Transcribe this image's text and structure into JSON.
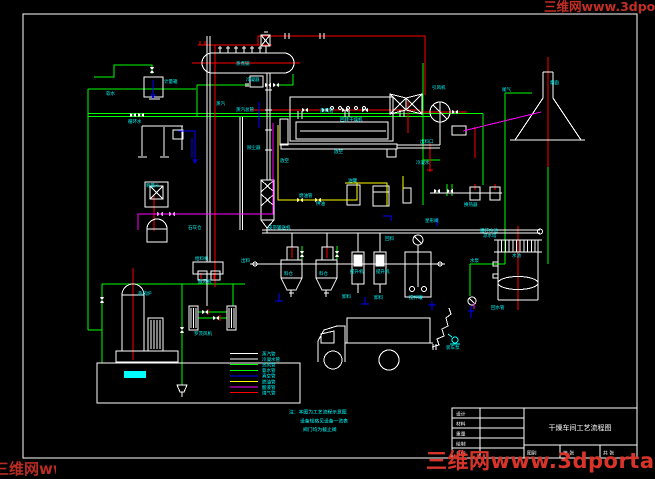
{
  "colors": {
    "background": "#000000",
    "frame": "#ffffff",
    "pipe_green": "#00ff00",
    "pipe_red": "#ff0000",
    "pipe_blue": "#0000ff",
    "pipe_yellow": "#ffff00",
    "pipe_magenta": "#ff00ff",
    "label_cyan": "#00ffff",
    "watermark_red": "#d8342a"
  },
  "watermark": {
    "text": "三维网www.3dportal.cn"
  },
  "legend": {
    "items": [
      {
        "color": "#ffffff",
        "label": "蒸汽管"
      },
      {
        "color": "#ffffff",
        "label": "冷凝水管"
      },
      {
        "color": "#00ff00",
        "label": "热风管"
      },
      {
        "color": "#00ff00",
        "label": "氨水管"
      },
      {
        "color": "#0000ff",
        "label": "真空管"
      },
      {
        "color": "#ffff00",
        "label": "燃油管"
      },
      {
        "color": "#ff00ff",
        "label": "酸液管"
      },
      {
        "color": "#ff0000",
        "label": "煤气管"
      }
    ]
  },
  "notes": {
    "lines": [
      "注：本图为工艺流程示意图",
      "设备规格见设备一览表",
      "阀门均为截止阀"
    ]
  },
  "title_block": {
    "rows": [
      {
        "label": "设计"
      },
      {
        "label": "材料"
      },
      {
        "label": "重量"
      },
      {
        "label": "绘制"
      },
      {
        "label": "日期"
      }
    ],
    "title": "干燥车间工艺流程图",
    "bottom_cells": [
      "图别",
      "第 张",
      "共 张"
    ]
  },
  "labels": [
    {
      "x": 164,
      "y": 83,
      "t": "计量箱"
    },
    {
      "x": 106,
      "y": 95,
      "t": "软水"
    },
    {
      "x": 236,
      "y": 65,
      "t": "蒸煮锅"
    },
    {
      "x": 246,
      "y": 81,
      "t": "冷凝器"
    },
    {
      "x": 128,
      "y": 123,
      "t": "循环水"
    },
    {
      "x": 236,
      "y": 111,
      "t": "蒸汽总管"
    },
    {
      "x": 320,
      "y": 112,
      "t": "热风管"
    },
    {
      "x": 340,
      "y": 121,
      "t": "回转干燥机"
    },
    {
      "x": 420,
      "y": 143,
      "t": "出料口"
    },
    {
      "x": 432,
      "y": 89,
      "t": "引风机"
    },
    {
      "x": 550,
      "y": 84,
      "t": "烟囱"
    },
    {
      "x": 247,
      "y": 149,
      "t": "除尘器"
    },
    {
      "x": 280,
      "y": 162,
      "t": "放空"
    },
    {
      "x": 334,
      "y": 153,
      "t": "放空"
    },
    {
      "x": 299,
      "y": 197,
      "t": "燃油管"
    },
    {
      "x": 316,
      "y": 205,
      "t": "供油"
    },
    {
      "x": 348,
      "y": 182,
      "t": "油罐"
    },
    {
      "x": 416,
      "y": 164,
      "t": "冷凝水"
    },
    {
      "x": 268,
      "y": 229,
      "t": "皮带输送机"
    },
    {
      "x": 241,
      "y": 262,
      "t": "出料"
    },
    {
      "x": 284,
      "y": 275,
      "t": "料仓"
    },
    {
      "x": 319,
      "y": 275,
      "t": "料仓"
    },
    {
      "x": 350,
      "y": 273,
      "t": "提升机"
    },
    {
      "x": 376,
      "y": 273,
      "t": "提升机"
    },
    {
      "x": 342,
      "y": 298,
      "t": "卸料"
    },
    {
      "x": 374,
      "y": 299,
      "t": "卸料"
    },
    {
      "x": 409,
      "y": 299,
      "t": "搅拌罐"
    },
    {
      "x": 480,
      "y": 232,
      "t": "循环水池"
    },
    {
      "x": 483,
      "y": 237,
      "t": "凉水塔"
    },
    {
      "x": 512,
      "y": 257,
      "t": "水池"
    },
    {
      "x": 470,
      "y": 262,
      "t": "水泵"
    },
    {
      "x": 491,
      "y": 309,
      "t": "回水管"
    },
    {
      "x": 446,
      "y": 349,
      "t": "装车泵"
    },
    {
      "x": 146,
      "y": 187,
      "t": "称量斗"
    },
    {
      "x": 188,
      "y": 229,
      "t": "石灰仓"
    },
    {
      "x": 138,
      "y": 295,
      "t": "热风炉"
    },
    {
      "x": 198,
      "y": 283,
      "t": "鼓风机"
    },
    {
      "x": 194,
      "y": 335,
      "t": "罗茨风机"
    },
    {
      "x": 195,
      "y": 260,
      "t": "给料机"
    },
    {
      "x": 216,
      "y": 105,
      "t": "蒸汽"
    },
    {
      "x": 464,
      "y": 206,
      "t": "换热器"
    },
    {
      "x": 502,
      "y": 91,
      "t": "尾气"
    },
    {
      "x": 425,
      "y": 222,
      "t": "星形阀"
    },
    {
      "x": 385,
      "y": 240,
      "t": "回料"
    }
  ]
}
